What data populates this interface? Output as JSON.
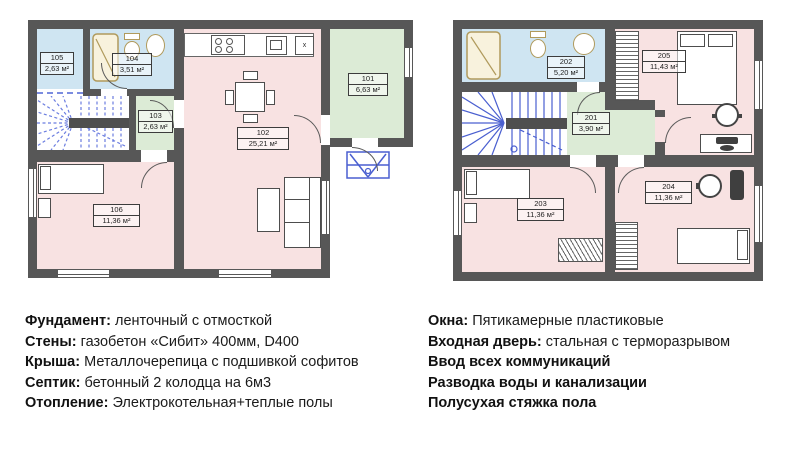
{
  "document_type": "house floor plan sheet, two floors with specifications",
  "floor1": {
    "rooms": [
      {
        "number": "101",
        "area": "6,63 м²"
      },
      {
        "number": "102",
        "area": "25,21 м²"
      },
      {
        "number": "103",
        "area": "2,63 м²"
      },
      {
        "number": "104",
        "area": "3,51 м²"
      },
      {
        "number": "105",
        "area": "2,63 м²"
      },
      {
        "number": "106",
        "area": "11,36 м²"
      }
    ]
  },
  "floor2": {
    "rooms": [
      {
        "number": "201",
        "area": "3,90 м²"
      },
      {
        "number": "202",
        "area": "5,20 м²"
      },
      {
        "number": "203",
        "area": "11,36 м²"
      },
      {
        "number": "204",
        "area": "11,36 м²"
      },
      {
        "number": "205",
        "area": "11,43 м²"
      }
    ]
  },
  "kitchen": {
    "x_label": "x"
  },
  "specs_left": [
    {
      "label": "Фундамент:",
      "text": "ленточный с отмосткой"
    },
    {
      "label": "Стены:",
      "text": "газобетон «Сибит» 400мм, D400"
    },
    {
      "label": "Крыша:",
      "text": "Металлочерепица с подшивкой софитов"
    },
    {
      "label": "Септик:",
      "text": "бетонный 2 колодца на 6м3"
    },
    {
      "label": "Отопление:",
      "text": "Электрокотельная+теплые полы"
    }
  ],
  "specs_right": [
    {
      "label": "Окна:",
      "text": "Пятикамерные пластиковые"
    },
    {
      "label": "Входная дверь:",
      "text": "стальная с терморазрывом"
    },
    {
      "label": "Ввод всех коммуникаций",
      "text": ""
    },
    {
      "label": "Разводка воды и канализации",
      "text": ""
    },
    {
      "label": "Полусухая стяжка пола",
      "text": ""
    }
  ],
  "colors": {
    "wall": "#575757",
    "room_pink": "#f8e2e2",
    "room_blue": "#cfe5f2",
    "room_green": "#dcebd6",
    "stair_blue": "#4a5fd0",
    "fixture_tan": "#b09a5c"
  }
}
